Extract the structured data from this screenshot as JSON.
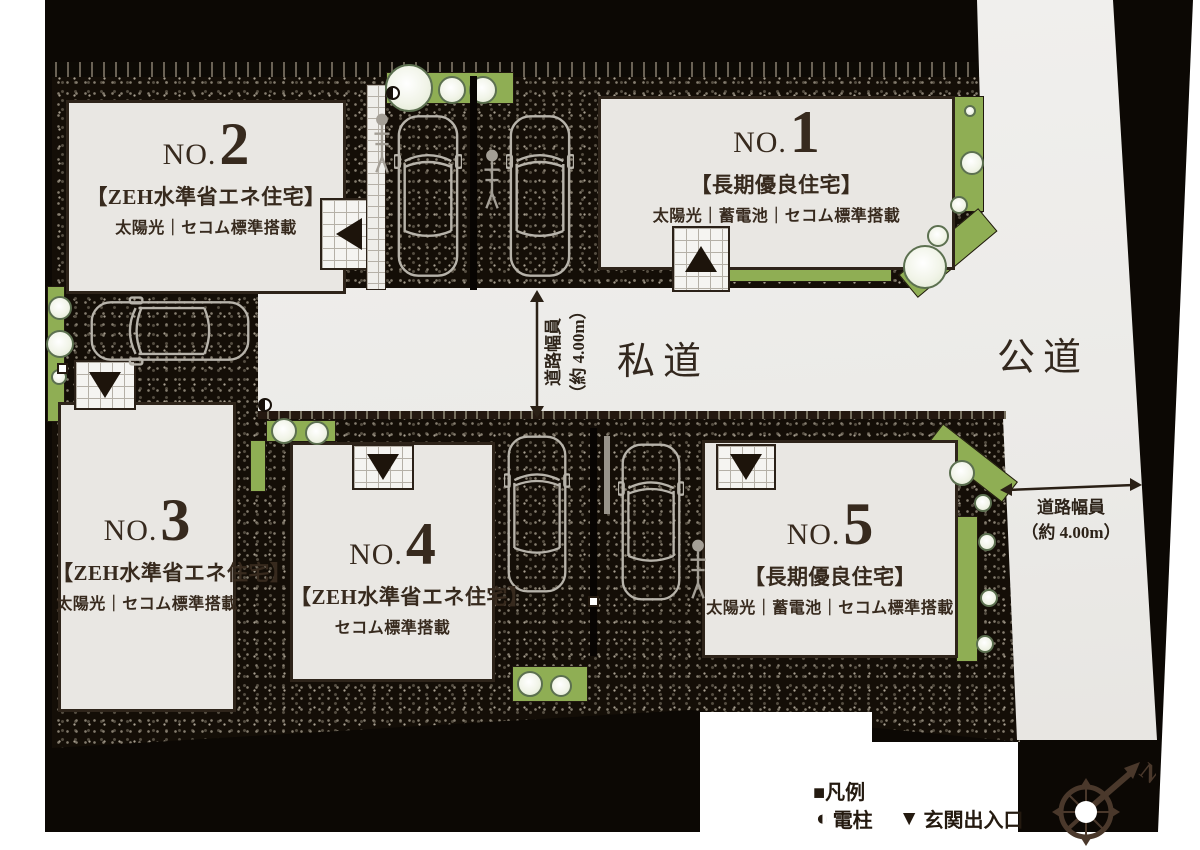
{
  "title": "全体区画図（全5区画）",
  "colors": {
    "site_black": "#0c0804",
    "lot_fill": "#e9e7e3",
    "road_fill": "#efeeec",
    "greenery": "#8fae54",
    "ink": "#372a1e"
  },
  "lots": [
    {
      "prefix": "NO.",
      "number": "1",
      "type": "【長期優良住宅】",
      "features": "太陽光｜蓄電池｜セコム標準搭載"
    },
    {
      "prefix": "NO.",
      "number": "2",
      "type": "【ZEH水準省エネ住宅】",
      "features": "太陽光｜セコム標準搭載"
    },
    {
      "prefix": "NO.",
      "number": "3",
      "type": "【ZEH水準省エネ住宅】",
      "features": "太陽光｜セコム標準搭載"
    },
    {
      "prefix": "NO.",
      "number": "4",
      "type": "【ZEH水準省エネ住宅】",
      "features": "セコム標準搭載"
    },
    {
      "prefix": "NO.",
      "number": "5",
      "type": "【長期優良住宅】",
      "features": "太陽光｜蓄電池｜セコム標準搭載"
    }
  ],
  "roads": {
    "private": "私道",
    "public": "公道",
    "width_line1": "道路幅員",
    "width_line2": "（約 4.00m）"
  },
  "legend": {
    "title": "■凡例",
    "items": [
      {
        "symbol": "◐",
        "label": "電柱"
      },
      {
        "symbol": "▼",
        "label": "玄関出入口"
      }
    ]
  },
  "compass": {
    "north_label": "N"
  }
}
